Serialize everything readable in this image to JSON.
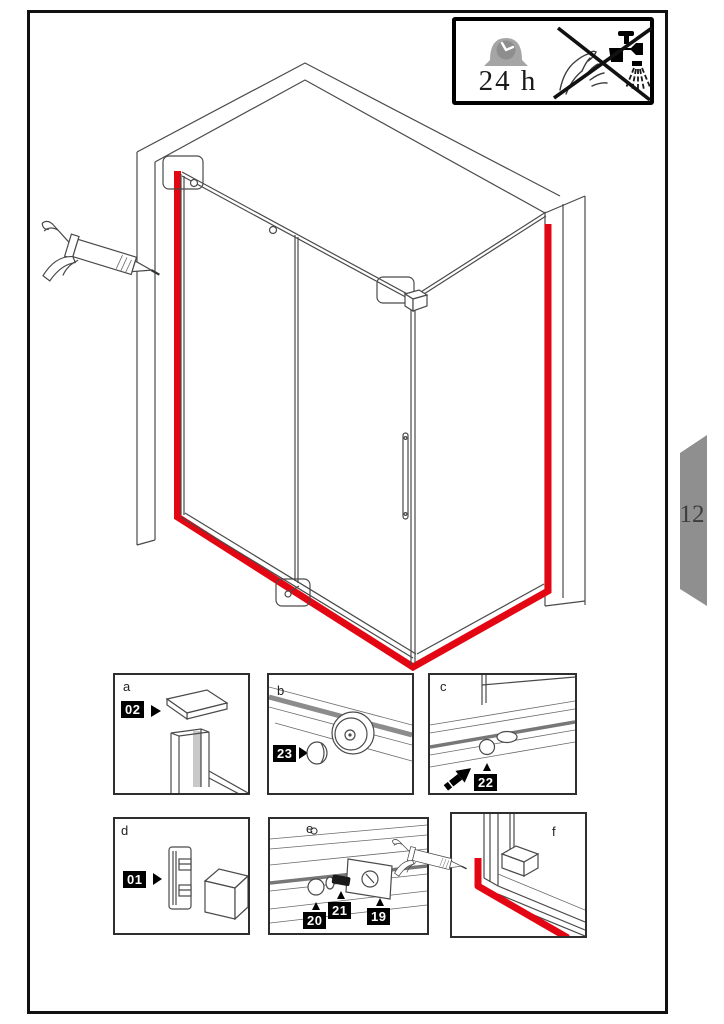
{
  "page": {
    "number": "12"
  },
  "info_box": {
    "duration": "24 h",
    "icons": {
      "clock": "clock-icon",
      "crossed_out": "no-handwash-no-shower-icon"
    }
  },
  "tools": {
    "caulk_gun": "caulk-gun-icon"
  },
  "colors": {
    "sealant_red": "#e30613",
    "tab_gray": "#8f8f8f",
    "clock_gray": "#a5a5a5",
    "line": "#4a4a4a"
  },
  "panels": [
    {
      "label": "a",
      "parts": [
        {
          "number": "02"
        }
      ]
    },
    {
      "label": "b",
      "parts": [
        {
          "number": "23"
        }
      ]
    },
    {
      "label": "c",
      "parts": [
        {
          "number": "22"
        }
      ]
    },
    {
      "label": "d",
      "parts": [
        {
          "number": "01"
        }
      ]
    },
    {
      "label": "e",
      "parts": [
        {
          "number": "20"
        },
        {
          "number": "21"
        },
        {
          "number": "19"
        }
      ]
    },
    {
      "label": "f",
      "parts": []
    }
  ]
}
